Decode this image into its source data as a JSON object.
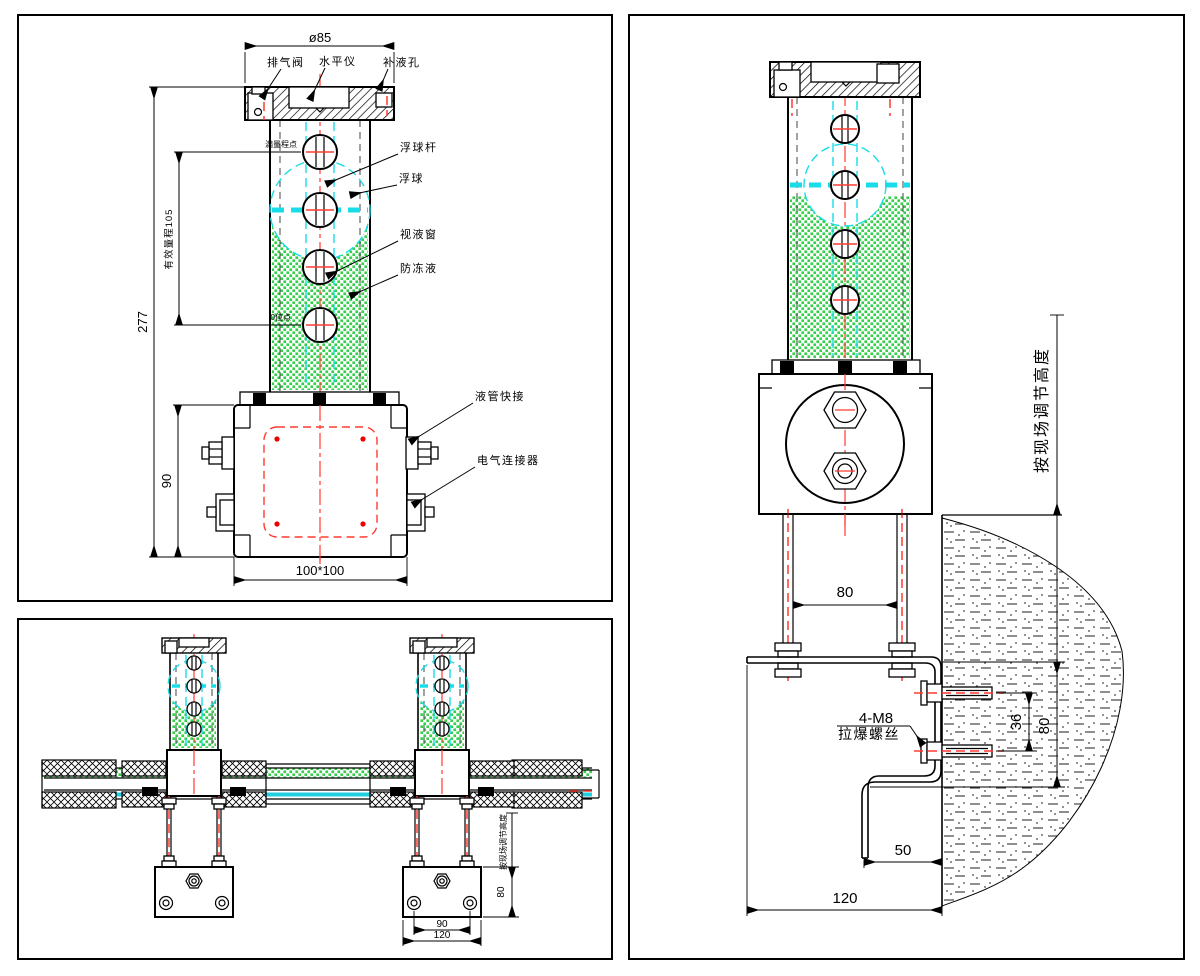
{
  "drawing": {
    "front_view": {
      "dim_diameter": "ø85",
      "dim_overall_height": "277",
      "dim_effective_range": "有效量程105",
      "dim_base_height": "90",
      "dim_base_size": "100*100",
      "label_exhaust_valve": "排气阀",
      "label_level_gauge": "水平仪",
      "label_refill_hole": "补液孔",
      "label_float_rod": "浮球杆",
      "label_float": "浮球",
      "label_sight_window": "视液窗",
      "label_antifreeze": "防冻液",
      "label_full_scale_point": "满量程点",
      "label_zero_point": "0位点",
      "label_pipe_quick_connector": "液管快接",
      "label_electrical_connector": "电气连接器"
    },
    "piping_view": {
      "dim_hole_spacing": "90",
      "dim_plate_width": "120",
      "dim_plate_height": "80",
      "note_adjust_height": "按现场调节高度"
    },
    "side_view": {
      "dim_stud_spacing": "80",
      "dim_bolt_spacing": "36",
      "dim_bracket_height": "80",
      "dim_lip_offset": "50",
      "dim_bracket_width": "120",
      "label_anchor_spec": "4-M8",
      "label_anchor_name": "拉爆螺丝",
      "note_adjust_height": "按现场调节高度"
    },
    "colors": {
      "liquid_green": "#35d04a",
      "float_cyan": "#18dde8",
      "centerline_red": "#ff3b30",
      "line_black": "#000000"
    }
  }
}
